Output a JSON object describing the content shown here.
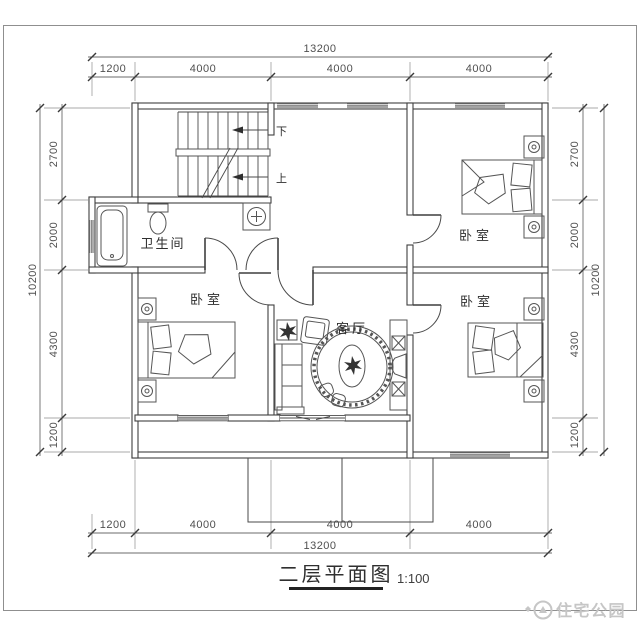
{
  "document": {
    "title": "二层平面图",
    "scale": "1:100",
    "watermark": "住宅公园"
  },
  "rooms": {
    "bathroom": {
      "label": "卫生间"
    },
    "bedroom_ne": {
      "label": "卧室"
    },
    "bedroom_sw": {
      "label": "卧室"
    },
    "bedroom_se": {
      "label": "卧室"
    },
    "living": {
      "label": "客厅"
    }
  },
  "stairs": {
    "down_label": "下",
    "up_label": "上"
  },
  "dimensions": {
    "top": {
      "total": "13200",
      "segments": [
        "1200",
        "4000",
        "4000",
        "4000"
      ]
    },
    "bottom": {
      "total": "13200",
      "segments": [
        "1200",
        "4000",
        "4000",
        "4000"
      ]
    },
    "left": {
      "total": "10200",
      "segments": [
        "2700",
        "2000",
        "4300",
        "1200"
      ]
    },
    "right": {
      "total": "10200",
      "segments": [
        "2700",
        "2000",
        "4300",
        "1200"
      ]
    }
  },
  "colors": {
    "line": "#3f3f3f",
    "dim_text": "#4f4f4f",
    "watermark": "#c6c6c6",
    "border": "#8f8f8f"
  }
}
